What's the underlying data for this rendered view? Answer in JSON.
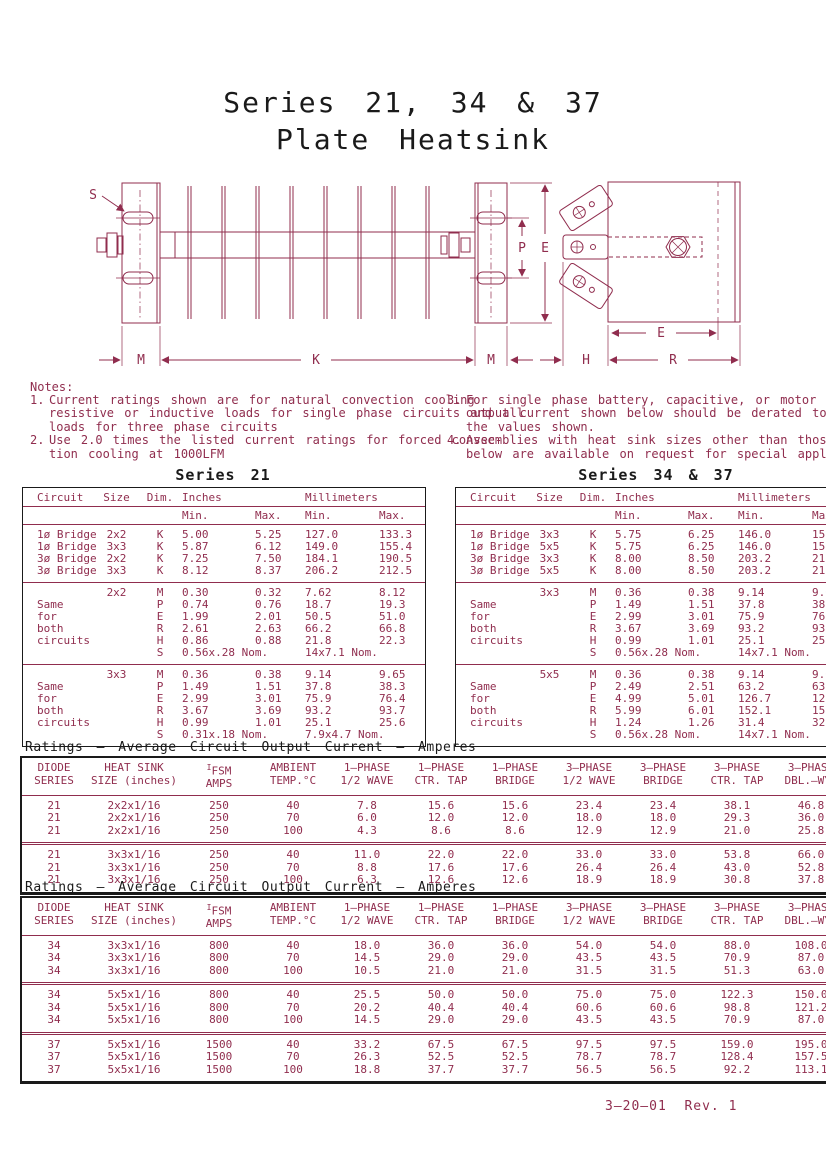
{
  "page": {
    "title_line1": "Series 21, 34 & 37",
    "title_line2": "Plate Heatsink",
    "footer": "3–20–01  Rev. 1"
  },
  "colors": {
    "accent": "#902d4e",
    "ink": "#1a1a1a",
    "background": "#ffffff"
  },
  "drawing": {
    "labels": {
      "s": "S",
      "m1": "M",
      "k": "K",
      "m2": "M",
      "p": "P",
      "e1": "E",
      "e2": "E",
      "h": "H",
      "r": "R"
    }
  },
  "notes": {
    "heading": "Notes:",
    "left": [
      {
        "num": "1.",
        "lines": [
          "Current ratings shown are for natural convection cooling",
          "resistive or inductive loads for single phase circuits and all",
          "loads for three phase circuits"
        ]
      },
      {
        "num": "2.",
        "lines": [
          "Use 2.0 times the listed current ratings for forced convec-",
          "tion cooling at 1000LFM"
        ]
      }
    ],
    "right": [
      {
        "num": "3.",
        "lines": [
          "For single phase battery, capacitive, or motor loads: t",
          "output current shown below should be derated to 80%",
          "the values shown."
        ]
      },
      {
        "num": "4.",
        "lines": [
          "Assemblies with heat sink sizes other than those show",
          "below are available on request for special applications."
        ]
      }
    ]
  },
  "dim_headers": {
    "circuit": "Circuit",
    "size": "Size",
    "dim": "Dim.",
    "inches": "Inches",
    "mm": "Millimeters",
    "min": "Min.",
    "max": "Max."
  },
  "series21": {
    "title": "Series 21",
    "groups": [
      {
        "rows": [
          [
            "1ø Bridge",
            "2x2",
            "K",
            "5.00",
            "5.25",
            "127.0",
            "133.3"
          ],
          [
            "1ø Bridge",
            "3x3",
            "K",
            "5.87",
            "6.12",
            "149.0",
            "155.4"
          ],
          [
            "3ø Bridge",
            "2x2",
            "K",
            "7.25",
            "7.50",
            "184.1",
            "190.5"
          ],
          [
            "3ø Bridge",
            "3x3",
            "K",
            "8.12",
            "8.37",
            "206.2",
            "212.5"
          ]
        ]
      },
      {
        "rows": [
          [
            "",
            "2x2",
            "M",
            "0.30",
            "0.32",
            "7.62",
            "8.12"
          ],
          [
            "Same",
            "",
            "P",
            "0.74",
            "0.76",
            "18.7",
            "19.3"
          ],
          [
            "for",
            "",
            "E",
            "1.99",
            "2.01",
            "50.5",
            "51.0"
          ],
          [
            "both",
            "",
            "R",
            "2.61",
            "2.63",
            "66.2",
            "66.8"
          ],
          [
            "circuits",
            "",
            "H",
            "0.86",
            "0.88",
            "21.8",
            "22.3"
          ],
          [
            "",
            "",
            "S",
            "0.56x.28 Nom.",
            "",
            "14x7.1 Nom.",
            ""
          ]
        ]
      },
      {
        "rows": [
          [
            "",
            "3x3",
            "M",
            "0.36",
            "0.38",
            "9.14",
            "9.65"
          ],
          [
            "Same",
            "",
            "P",
            "1.49",
            "1.51",
            "37.8",
            "38.3"
          ],
          [
            "for",
            "",
            "E",
            "2.99",
            "3.01",
            "75.9",
            "76.4"
          ],
          [
            "both",
            "",
            "R",
            "3.67",
            "3.69",
            "93.2",
            "93.7"
          ],
          [
            "circuits",
            "",
            "H",
            "0.99",
            "1.01",
            "25.1",
            "25.6"
          ],
          [
            "",
            "",
            "S",
            "0.31x.18 Nom.",
            "",
            "7.9x4.7 Nom.",
            ""
          ]
        ]
      }
    ]
  },
  "series3437": {
    "title": "Series 34 & 37",
    "groups": [
      {
        "rows": [
          [
            "1ø Bridge",
            "3x3",
            "K",
            "5.75",
            "6.25",
            "146.0",
            "158.7"
          ],
          [
            "1ø Bridge",
            "5x5",
            "K",
            "5.75",
            "6.25",
            "146.0",
            "158.7"
          ],
          [
            "3ø Bridge",
            "3x3",
            "K",
            "8.00",
            "8.50",
            "203.2",
            "215.9"
          ],
          [
            "3ø Bridge",
            "5x5",
            "K",
            "8.00",
            "8.50",
            "203.2",
            "215.9"
          ]
        ]
      },
      {
        "rows": [
          [
            "",
            "3x3",
            "M",
            "0.36",
            "0.38",
            "9.14",
            "9.65"
          ],
          [
            "Same",
            "",
            "P",
            "1.49",
            "1.51",
            "37.8",
            "38.3"
          ],
          [
            "for",
            "",
            "E",
            "2.99",
            "3.01",
            "75.9",
            "76.4"
          ],
          [
            "both",
            "",
            "R",
            "3.67",
            "3.69",
            "93.2",
            "93.7"
          ],
          [
            "circuits",
            "",
            "H",
            "0.99",
            "1.01",
            "25.1",
            "25.6"
          ],
          [
            "",
            "",
            "S",
            "0.56x.28 Nom.",
            "",
            "14x7.1 Nom.",
            ""
          ]
        ]
      },
      {
        "rows": [
          [
            "",
            "5x5",
            "M",
            "0.36",
            "0.38",
            "9.14",
            "9.65"
          ],
          [
            "Same",
            "",
            "P",
            "2.49",
            "2.51",
            "63.2",
            "63.7"
          ],
          [
            "for",
            "",
            "E",
            "4.99",
            "5.01",
            "126.7",
            "127.2"
          ],
          [
            "both",
            "",
            "R",
            "5.99",
            "6.01",
            "152.1",
            "152.6"
          ],
          [
            "circuits",
            "",
            "H",
            "1.24",
            "1.26",
            "31.4",
            "32.0"
          ],
          [
            "",
            "",
            "S",
            "0.56x.28 Nom.",
            "",
            "14x7.1 Nom.",
            ""
          ]
        ]
      }
    ]
  },
  "ratings_shared": {
    "title": "Ratings – Average Circuit Output Current – Amperes",
    "col_headers": [
      {
        "line1": "DIODE",
        "line2": "SERIES"
      },
      {
        "line1": "HEAT SINK",
        "line2": "SIZE (inches)"
      },
      {
        "line1": "IFSM",
        "line2": "AMPS",
        "sup_first": true
      },
      {
        "line1": "AMBIENT",
        "line2": "TEMP.°C"
      },
      {
        "line1": "1–PHASE",
        "line2": "1/2 WAVE"
      },
      {
        "line1": "1–PHASE",
        "line2": "CTR. TAP"
      },
      {
        "line1": "1–PHASE",
        "line2": "BRIDGE"
      },
      {
        "line1": "3–PHASE",
        "line2": "1/2 WAVE"
      },
      {
        "line1": "3–PHASE",
        "line2": "BRIDGE"
      },
      {
        "line1": "3–PHASE",
        "line2": "CTR. TAP"
      },
      {
        "line1": "3–PHASE",
        "line2": "DBL.–WYE"
      }
    ]
  },
  "ratings1": {
    "groups": [
      {
        "rows": [
          [
            "21",
            "2x2x1/16",
            "250",
            "40",
            "7.8",
            "15.6",
            "15.6",
            "23.4",
            "23.4",
            "38.1",
            "46.8"
          ],
          [
            "21",
            "2x2x1/16",
            "250",
            "70",
            "6.0",
            "12.0",
            "12.0",
            "18.0",
            "18.0",
            "29.3",
            "36.0"
          ],
          [
            "21",
            "2x2x1/16",
            "250",
            "100",
            "4.3",
            "8.6",
            "8.6",
            "12.9",
            "12.9",
            "21.0",
            "25.8"
          ]
        ]
      },
      {
        "rows": [
          [
            "21",
            "3x3x1/16",
            "250",
            "40",
            "11.0",
            "22.0",
            "22.0",
            "33.0",
            "33.0",
            "53.8",
            "66.0"
          ],
          [
            "21",
            "3x3x1/16",
            "250",
            "70",
            "8.8",
            "17.6",
            "17.6",
            "26.4",
            "26.4",
            "43.0",
            "52.8"
          ],
          [
            "21",
            "3x3x1/16",
            "250",
            "100",
            "6.3",
            "12.6",
            "12.6",
            "18.9",
            "18.9",
            "30.8",
            "37.8"
          ]
        ]
      }
    ]
  },
  "ratings2": {
    "groups": [
      {
        "rows": [
          [
            "34",
            "3x3x1/16",
            "800",
            "40",
            "18.0",
            "36.0",
            "36.0",
            "54.0",
            "54.0",
            "88.0",
            "108.0"
          ],
          [
            "34",
            "3x3x1/16",
            "800",
            "70",
            "14.5",
            "29.0",
            "29.0",
            "43.5",
            "43.5",
            "70.9",
            "87.0"
          ],
          [
            "34",
            "3x3x1/16",
            "800",
            "100",
            "10.5",
            "21.0",
            "21.0",
            "31.5",
            "31.5",
            "51.3",
            "63.0"
          ]
        ]
      },
      {
        "rows": [
          [
            "34",
            "5x5x1/16",
            "800",
            "40",
            "25.5",
            "50.0",
            "50.0",
            "75.0",
            "75.0",
            "122.3",
            "150.0"
          ],
          [
            "34",
            "5x5x1/16",
            "800",
            "70",
            "20.2",
            "40.4",
            "40.4",
            "60.6",
            "60.6",
            "98.8",
            "121.2"
          ],
          [
            "34",
            "5x5x1/16",
            "800",
            "100",
            "14.5",
            "29.0",
            "29.0",
            "43.5",
            "43.5",
            "70.9",
            "87.0"
          ]
        ]
      },
      {
        "rows": [
          [
            "37",
            "5x5x1/16",
            "1500",
            "40",
            "33.2",
            "67.5",
            "67.5",
            "97.5",
            "97.5",
            "159.0",
            "195.0"
          ],
          [
            "37",
            "5x5x1/16",
            "1500",
            "70",
            "26.3",
            "52.5",
            "52.5",
            "78.7",
            "78.7",
            "128.4",
            "157.5"
          ],
          [
            "37",
            "5x5x1/16",
            "1500",
            "100",
            "18.8",
            "37.7",
            "37.7",
            "56.5",
            "56.5",
            "92.2",
            "113.1"
          ]
        ]
      }
    ]
  }
}
